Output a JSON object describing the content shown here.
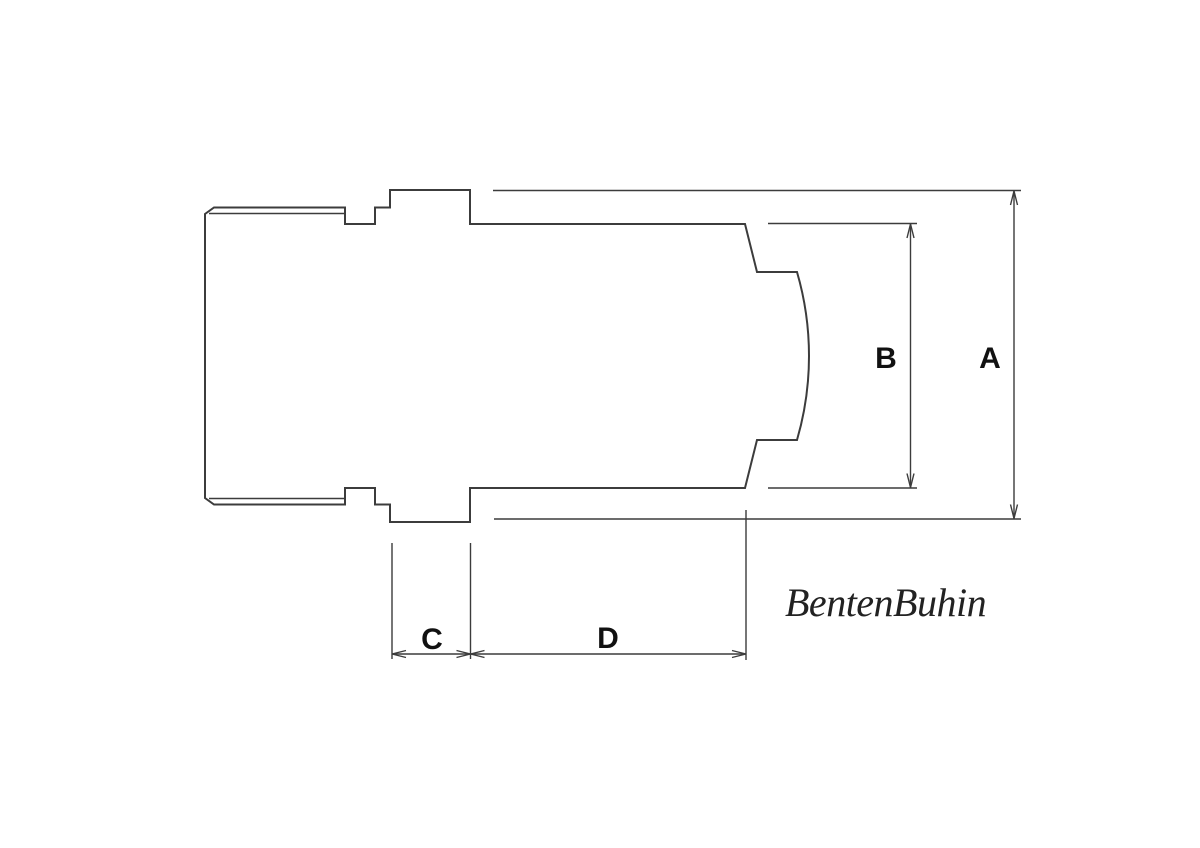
{
  "drawing": {
    "background": "#ffffff",
    "colors": {
      "line": "#3c3c3c",
      "label": "#111111",
      "signature": "#222222"
    },
    "dimensions": {
      "a": {
        "label": "A"
      },
      "b": {
        "label": "B"
      },
      "c": {
        "label": "C"
      },
      "d": {
        "label": "D"
      }
    },
    "signature": "BentenBuhin"
  }
}
